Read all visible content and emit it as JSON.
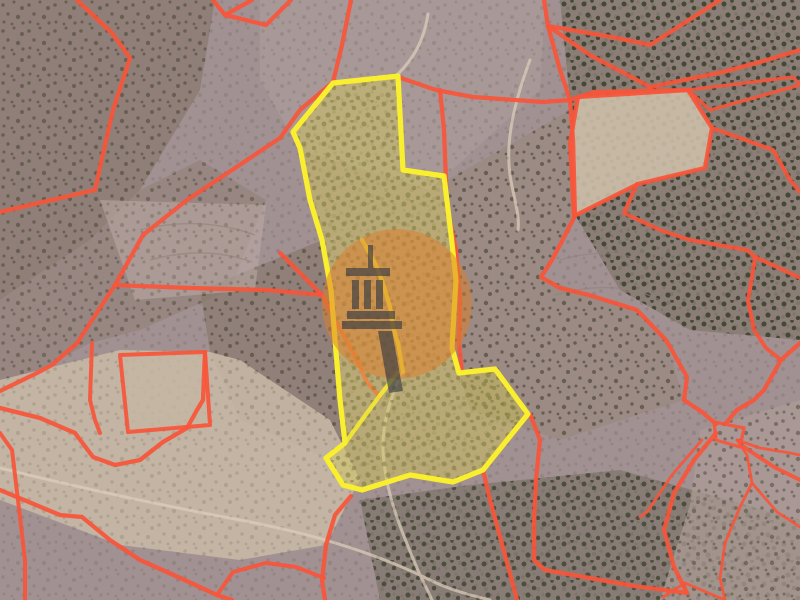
{
  "map": {
    "description": "Aerial cadastral map: satellite terrain with red parcel boundary lines, a highlighted plot outlined in yellow, and an orange circular watermark with a building-columns logo",
    "colors": {
      "boundary_red": "#f8553a",
      "highlight_stroke": "#f9ef2e",
      "highlight_fill": "#d9cc4e",
      "watermark_circle": "#dd7f2c",
      "watermark_icon": "#3a3c45",
      "terrain_base": "#a29192"
    },
    "highlighted_parcel": {
      "outline": "398,76 403,170 444,176 452,243 456,280 453,330 452,348 459,373 495,369 528,414 483,470 453,482 410,475 362,490 343,485 326,458 345,443 340,400 335,340 331,290 322,240 310,200 300,148 293,132 333,83",
      "inner_lines": [
        "362,240 375,263 383,283 390,307 393,327 398,343 403,372",
        "345,443 378,398 398,372"
      ],
      "stroke_width": 5.2,
      "fill_opacity": 0.4
    },
    "boundary_lines": [
      {
        "points": "77,0 112,33 130,58 113,110 100,167 95,190 43,202 0,212",
        "w": 4.3
      },
      {
        "points": "213,0 225,15 252,0",
        "w": 4.3
      },
      {
        "points": "225,15 266,25 291,0",
        "w": 4.3
      },
      {
        "points": "351,0 342,45 333,82",
        "w": 4.3
      },
      {
        "points": "333,82 300,110 280,138 187,200 143,235 115,285 77,343 52,365 37,373 0,391",
        "w": 4.3
      },
      {
        "points": "398,77 436,90 473,97 543,102 570,100 594,92 688,90",
        "w": 4.3
      },
      {
        "points": "544,0 548,26 617,38 650,45 720,0",
        "w": 4.3
      },
      {
        "points": "548,26 590,55 650,87 723,72 767,60 800,50",
        "w": 4.3
      },
      {
        "points": "548,26 560,70 570,100",
        "w": 4.3
      },
      {
        "points": "570,100 573,140 575,216",
        "w": 4.3
      },
      {
        "points": "440,90 444,130 447,207 456,250 460,300 459,345 462,372",
        "w": 4.3
      },
      {
        "points": "483,470 490,500 499,533 509,570 517,600",
        "w": 4.3
      },
      {
        "points": "530,414 540,440 536,480 534,522 534,560 545,570 584,577 634,586 687,593",
        "w": 4.3
      },
      {
        "points": "684,400 702,412 716,424",
        "w": 4.3
      },
      {
        "points": "716,433 694,460 674,493 664,530 674,567 687,593",
        "w": 4.3
      },
      {
        "points": "726,423 737,410 754,400 764,390 781,360 800,343",
        "w": 4.3
      },
      {
        "points": "575,216 560,245 552,260 541,277 560,288 589,295 637,310 666,340 687,377 684,400",
        "w": 4.3
      },
      {
        "points": "280,253 322,295 357,360 367,382 380,397",
        "w": 4.3
      },
      {
        "points": "115,285 190,288 266,290 322,295",
        "w": 4.3
      },
      {
        "points": "92,343 90,400 95,420 100,433",
        "w": 4
      },
      {
        "points": "0,408 40,418 75,433 93,457 115,465 140,460 163,442 187,428 197,410 203,400 205,352",
        "w": 4.3
      },
      {
        "points": "0,490 60,515 82,517 110,540 140,560 178,577 217,595 232,600",
        "w": 4.3
      },
      {
        "points": "0,433 12,450 20,517 25,560 25,600",
        "w": 4
      },
      {
        "points": "351,496 335,515 326,545 322,580 325,600",
        "w": 4.3
      },
      {
        "points": "324,578 296,567 266,563 233,572 217,595",
        "w": 4
      },
      {
        "points": "637,184 624,213 660,230 690,240 747,250 755,257",
        "w": 4
      },
      {
        "points": "755,257 752,277 748,300 754,330 766,348 781,360",
        "w": 4
      },
      {
        "points": "755,257 777,267 800,278",
        "w": 4
      },
      {
        "points": "712,128 740,138 773,150 790,180 800,192",
        "w": 4
      },
      {
        "points": "744,447 774,467 800,480",
        "w": 4
      },
      {
        "points": "737,440 747,455 752,483 740,507 725,543 720,578 725,600",
        "w": 2.8
      },
      {
        "points": "752,483 777,512 800,527",
        "w": 2.8
      },
      {
        "points": "702,440 672,475 647,512 640,517",
        "w": 2.8
      },
      {
        "points": "725,600 685,583 663,597",
        "w": 2.8
      },
      {
        "points": "737,440 760,448 790,453 800,455",
        "w": 2.8
      }
    ],
    "boundary_polygons": [
      {
        "points": "578,97 688,90 712,128 705,168 638,184 574,216 570,143",
        "fill": "#cfc0ab",
        "fill_opacity": 0.88,
        "w": 4.3
      },
      {
        "points": "688,90 793,77 800,85 710,110",
        "fill": "none",
        "fill_opacity": 1,
        "w": 3.4
      },
      {
        "points": "714,422 744,428 740,447 716,440",
        "fill": "none",
        "fill_opacity": 1,
        "w": 3.2
      },
      {
        "points": "120,355 205,352 210,425 128,432",
        "fill": "#c6b7a3",
        "fill_opacity": 0.75,
        "w": 4
      }
    ],
    "watermark": {
      "icon_name": "building-columns-logo",
      "cx": 397,
      "cy": 304,
      "r": 75,
      "circle_opacity": 0.52,
      "icon_opacity": 0.66,
      "icon_rects": [
        [
          368,
          245,
          5,
          25
        ],
        [
          346,
          268,
          44,
          8
        ],
        [
          352,
          280,
          7,
          29
        ],
        [
          364,
          280,
          7,
          29
        ],
        [
          376,
          280,
          7,
          29
        ],
        [
          347,
          311,
          48,
          8
        ],
        [
          342,
          321,
          60,
          8
        ]
      ],
      "icon_tail": "378,331 392,331 403,391 389,393"
    }
  }
}
